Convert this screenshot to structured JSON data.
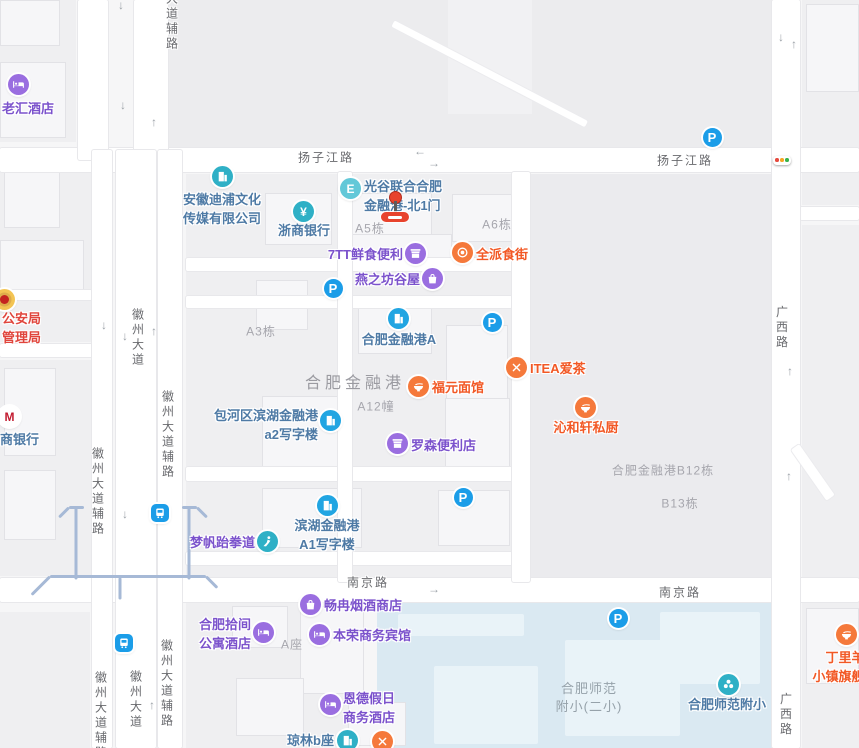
{
  "app": {
    "title": "合肥金融港地图"
  },
  "colors": {
    "bg": "#f6f6f7",
    "plot": "#efeff1",
    "block": "#ececee",
    "plot_dark": "#ebebee",
    "campus": "#dae9f2",
    "metro_line": "#a6b9d6",
    "poi_purple": "#7b52cc",
    "poi_purple_icon": "#9a6ee0",
    "poi_orange": "#f25825",
    "poi_orange_icon": "#f5793b",
    "poi_steel": "#4e7aa5",
    "poi_azure_icon": "#21a5e2",
    "poi_teal_icon": "#2fb0c6",
    "poi_exit_icon": "#63c8d8",
    "poi_red": "#e0453c",
    "parking_blue": "#1b9de8",
    "marker_red": "#e8432d",
    "tl_red": "#e5493d",
    "tl_orange": "#f5a623",
    "tl_green": "#37b24a"
  },
  "road_labels": [
    {
      "text": "扬子江路",
      "x": 326,
      "y": 157,
      "vertical": false
    },
    {
      "text": "扬子江路",
      "x": 685,
      "y": 160,
      "vertical": false
    },
    {
      "text": "南京路",
      "x": 368,
      "y": 582,
      "vertical": false
    },
    {
      "text": "南京路",
      "x": 680,
      "y": 592,
      "vertical": false
    },
    {
      "text": "大道辅路",
      "x": 172,
      "y": 22,
      "vertical": true
    },
    {
      "text": "徽州大道",
      "x": 138,
      "y": 338,
      "vertical": true
    },
    {
      "text": "徽州大道辅路",
      "x": 98,
      "y": 492,
      "vertical": true
    },
    {
      "text": "徽州大道辅路",
      "x": 168,
      "y": 435,
      "vertical": true
    },
    {
      "text": "徽州大道",
      "x": 136,
      "y": 700,
      "vertical": true
    },
    {
      "text": "徽州大道辅路",
      "x": 101,
      "y": 716,
      "vertical": true
    },
    {
      "text": "徽州大道辅路",
      "x": 167,
      "y": 684,
      "vertical": true
    },
    {
      "text": "广西路",
      "x": 782,
      "y": 328,
      "vertical": true
    },
    {
      "text": "广西路",
      "x": 786,
      "y": 715,
      "vertical": true
    }
  ],
  "area_labels": [
    {
      "id": "hefei-financial-port",
      "lines": [
        "合肥金融港"
      ],
      "x": 355,
      "y": 369
    }
  ],
  "campus_labels": [
    {
      "id": "hefei-normal-campus",
      "lines": [
        "合肥师范",
        "附小(二小)"
      ],
      "x": 589,
      "y": 680
    }
  ],
  "building_labels": [
    {
      "text": "A5栋",
      "x": 370,
      "y": 228
    },
    {
      "text": "A6栋",
      "x": 497,
      "y": 224
    },
    {
      "text": "A3栋",
      "x": 261,
      "y": 331
    },
    {
      "text": "A12幢",
      "x": 376,
      "y": 406
    },
    {
      "text": "合肥金融港B12栋",
      "x": 663,
      "y": 470
    },
    {
      "text": "B13栋",
      "x": 680,
      "y": 503
    },
    {
      "text": "A座",
      "x": 292,
      "y": 644
    }
  ],
  "pois": [
    {
      "id": "laohui-hotel",
      "lines": [
        "老汇酒店"
      ],
      "color": "purple",
      "icon": "bed",
      "ix": 18,
      "iy": 84,
      "anchor": {
        "type": "start",
        "x": 2,
        "y": 99
      }
    },
    {
      "id": "anhui-dipu-media",
      "lines": [
        "安徽迪浦文化",
        "传媒有限公司"
      ],
      "color": "steel",
      "icon": "building-teal",
      "ix": 222,
      "iy": 176,
      "anchor": {
        "type": "center",
        "x": 222,
        "y": 190
      }
    },
    {
      "id": "zheshang-bank",
      "lines": [
        "浙商银行"
      ],
      "color": "steel",
      "icon": "yen",
      "ix": 303,
      "iy": 211,
      "anchor": {
        "type": "center",
        "x": 304,
        "y": 221
      }
    },
    {
      "id": "guanggu-north-gate-1",
      "lines": [
        "光谷联合合肥",
        "金融港-北1门"
      ],
      "color": "steel",
      "icon": "exit",
      "ix": 350,
      "iy": 188,
      "anchor": {
        "type": "start",
        "x": 364,
        "y": 177
      }
    },
    {
      "id": "seven-tt-convenience",
      "lines": [
        "7TT鲜食便利"
      ],
      "color": "purple",
      "icon": "shop",
      "ix": 415,
      "iy": 253,
      "anchor": {
        "type": "end",
        "x": 403,
        "y": 245
      }
    },
    {
      "id": "quanpai-food-street",
      "lines": [
        "全派食街"
      ],
      "color": "orange",
      "icon": "plate",
      "ix": 462,
      "iy": 252,
      "anchor": {
        "type": "start",
        "x": 476,
        "y": 245
      }
    },
    {
      "id": "yanzhifang-guwu",
      "lines": [
        "燕之坊谷屋"
      ],
      "color": "purple",
      "icon": "bag",
      "ix": 432,
      "iy": 278,
      "anchor": {
        "type": "end",
        "x": 420,
        "y": 270
      }
    },
    {
      "id": "hefei-financial-port-a",
      "lines": [
        "合肥金融港A"
      ],
      "color": "steel",
      "icon": "building-azure",
      "ix": 398,
      "iy": 318,
      "anchor": {
        "type": "center",
        "x": 399,
        "y": 330
      }
    },
    {
      "id": "fuyuan-noodle",
      "lines": [
        "福元面馆"
      ],
      "color": "orange",
      "icon": "bowl",
      "ix": 418,
      "iy": 386,
      "anchor": {
        "type": "start",
        "x": 432,
        "y": 378
      }
    },
    {
      "id": "itea-tea",
      "lines": [
        "ITEA爱茶"
      ],
      "color": "orange",
      "icon": "forkx",
      "ix": 516,
      "iy": 367,
      "anchor": {
        "type": "start",
        "x": 530,
        "y": 359
      }
    },
    {
      "id": "qinhexuan-kitchen",
      "lines": [
        "沁和轩私厨"
      ],
      "color": "orange",
      "icon": "bowl",
      "ix": 585,
      "iy": 407,
      "anchor": {
        "type": "center",
        "x": 586,
        "y": 418
      }
    },
    {
      "id": "baohe-binhu-a2-office",
      "lines": [
        "包河区滨湖金融港",
        "a2写字楼"
      ],
      "color": "steel",
      "icon": "building-azure",
      "ix": 330,
      "iy": 420,
      "anchor": {
        "type": "end",
        "x": 318,
        "y": 406
      }
    },
    {
      "id": "lawson-convenience",
      "lines": [
        "罗森便利店"
      ],
      "color": "purple",
      "icon": "shop",
      "ix": 397,
      "iy": 443,
      "anchor": {
        "type": "start",
        "x": 411,
        "y": 436
      }
    },
    {
      "id": "mengfan-taekwondo",
      "lines": [
        "梦帆跆拳道"
      ],
      "color": "purple",
      "icon": "tkd",
      "ix": 267,
      "iy": 541,
      "anchor": {
        "type": "end",
        "x": 255,
        "y": 533
      }
    },
    {
      "id": "binhu-a1-office",
      "lines": [
        "滨湖金融港",
        "A1写字楼"
      ],
      "color": "steel",
      "icon": "building-azure",
      "ix": 327,
      "iy": 505,
      "anchor": {
        "type": "center",
        "x": 327,
        "y": 516
      }
    },
    {
      "id": "changran-tobacco-shop",
      "lines": [
        "畅冉烟酒商店"
      ],
      "color": "purple",
      "icon": "bag",
      "ix": 310,
      "iy": 604,
      "anchor": {
        "type": "start",
        "x": 324,
        "y": 596
      }
    },
    {
      "id": "hefei-shijian-apartment-hotel",
      "lines": [
        "合肥拾间",
        "公寓酒店"
      ],
      "color": "purple",
      "icon": "bed",
      "ix": 263,
      "iy": 632,
      "anchor": {
        "type": "end",
        "x": 251,
        "y": 615
      }
    },
    {
      "id": "benrong-hotel",
      "lines": [
        "本荣商务宾馆"
      ],
      "color": "purple",
      "icon": "bed",
      "ix": 319,
      "iy": 634,
      "anchor": {
        "type": "start",
        "x": 333,
        "y": 626
      }
    },
    {
      "id": "ende-holiday-hotel",
      "lines": [
        "恩德假日",
        "商务酒店"
      ],
      "color": "purple",
      "icon": "bed",
      "ix": 330,
      "iy": 704,
      "anchor": {
        "type": "start",
        "x": 343,
        "y": 689
      }
    },
    {
      "id": "qionglin-b",
      "lines": [
        "琼林b座"
      ],
      "color": "steel",
      "icon": "building-teal",
      "ix": 347,
      "iy": 740,
      "anchor": {
        "type": "end",
        "x": 334,
        "y": 731
      }
    },
    {
      "id": "restaurant-bottom",
      "lines": [],
      "color": "orange",
      "icon": "forkx",
      "ix": 382,
      "iy": 741,
      "anchor": {
        "type": "start",
        "x": 396,
        "y": 741
      }
    },
    {
      "id": "hefei-normal-primary",
      "lines": [
        "合肥师范附小"
      ],
      "color": "steel",
      "icon": "leaf",
      "ix": 728,
      "iy": 684,
      "anchor": {
        "type": "center",
        "x": 727,
        "y": 695
      }
    },
    {
      "id": "dingliyang-flagship",
      "lines": [
        "丁里羊",
        "小镇旗舰店"
      ],
      "color": "orange",
      "icon": "bowl",
      "ix": 846,
      "iy": 634,
      "anchor": {
        "type": "center",
        "x": 845,
        "y": 648
      }
    },
    {
      "id": "public-security-bureau",
      "lines": [
        "公安局",
        "管理局"
      ],
      "color": "red",
      "icon": "emblem",
      "ix": 4,
      "iy": 299,
      "anchor": {
        "type": "end",
        "x": 41,
        "y": 309
      }
    },
    {
      "id": "merchants-bank",
      "lines": [
        "商银行"
      ],
      "color": "steel",
      "icon": "cmb",
      "ix": 9,
      "iy": 416,
      "anchor": {
        "type": "start",
        "x": 0,
        "y": 430
      }
    }
  ],
  "parking_lots": [
    {
      "x": 712,
      "y": 137
    },
    {
      "x": 333,
      "y": 288
    },
    {
      "x": 492,
      "y": 322
    },
    {
      "x": 463,
      "y": 497
    },
    {
      "x": 618,
      "y": 618
    }
  ],
  "parking_glyph": "P",
  "bus_stops": [
    {
      "x": 160,
      "y": 513
    },
    {
      "x": 124,
      "y": 643
    }
  ],
  "traffic_light": {
    "x": 782,
    "y": 160
  },
  "marker": {
    "x": 395,
    "y": 197,
    "label": "北1门"
  },
  "arrows": [
    {
      "x": 121,
      "y": 5,
      "dir": "down"
    },
    {
      "x": 123,
      "y": 105,
      "dir": "down"
    },
    {
      "x": 154,
      "y": 122,
      "dir": "up"
    },
    {
      "x": 420,
      "y": 151,
      "dir": "left"
    },
    {
      "x": 434,
      "y": 163,
      "dir": "right"
    },
    {
      "x": 104,
      "y": 325,
      "dir": "down"
    },
    {
      "x": 125,
      "y": 336,
      "dir": "down"
    },
    {
      "x": 154,
      "y": 331,
      "dir": "up"
    },
    {
      "x": 125,
      "y": 514,
      "dir": "down"
    },
    {
      "x": 152,
      "y": 705,
      "dir": "up"
    },
    {
      "x": 434,
      "y": 589,
      "dir": "right"
    },
    {
      "x": 781,
      "y": 37,
      "dir": "down"
    },
    {
      "x": 794,
      "y": 44,
      "dir": "up"
    },
    {
      "x": 790,
      "y": 371,
      "dir": "up"
    },
    {
      "x": 789,
      "y": 476,
      "dir": "up"
    }
  ]
}
